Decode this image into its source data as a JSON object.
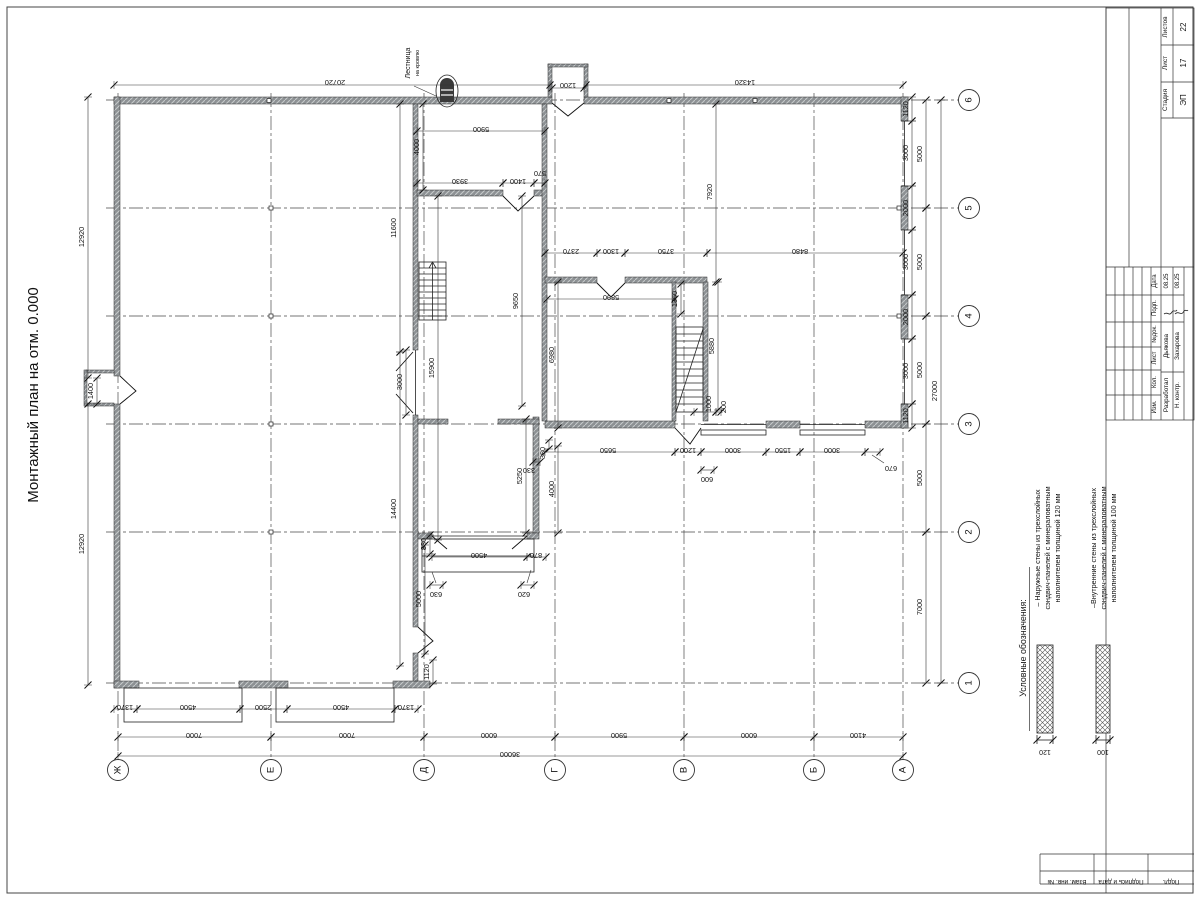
{
  "title": "Монтажный план на отм. 0.000",
  "roof_ladder_note": [
    "Лестница",
    "на кровлю"
  ],
  "legend": {
    "heading": "Условные обозначения:",
    "items": [
      {
        "lines": [
          "– Наружные стены из трехслойных",
          "сэндвич-панелей с минераловатным",
          "наполнителем толщиной 120 мм"
        ],
        "thickness": "120"
      },
      {
        "lines": [
          "–Внутренние стены из трехслойных",
          "сэндвич-панелей с минераловатным",
          "наполнителем толщиной 100 мм"
        ],
        "thickness": "100"
      }
    ]
  },
  "stamp": {
    "stadiya_label": "Стадия",
    "stadiya": "ЭП",
    "list_label": "Лист",
    "list": "17",
    "listov_label": "Листов",
    "listov": "22",
    "rev_headers": [
      "Дата",
      "Подп.",
      "№док.",
      "Лист",
      "Кол.",
      "Изм."
    ],
    "rows": [
      {
        "role": "Разработал",
        "name": "Дьякова",
        "date": "08.25"
      },
      {
        "role": "Н. контр.",
        "name": "Захарова",
        "date": "08.25"
      }
    ],
    "side_labels": [
      "Взам. инв. №",
      "Подпись и дата",
      "Подл."
    ]
  },
  "plan": {
    "axes": {
      "cols": [
        {
          "label": "Ж",
          "x": 118
        },
        {
          "label": "Е",
          "x": 271
        },
        {
          "label": "Д",
          "x": 424
        },
        {
          "label": "Г",
          "x": 555
        },
        {
          "label": "В",
          "x": 684
        },
        {
          "label": "Б",
          "x": 814
        },
        {
          "label": "А",
          "x": 903
        }
      ],
      "rows": [
        {
          "label": "6",
          "y": 100
        },
        {
          "label": "5",
          "y": 208
        },
        {
          "label": "4",
          "y": 316
        },
        {
          "label": "3",
          "y": 424
        },
        {
          "label": "2",
          "y": 532
        },
        {
          "label": "1",
          "y": 683
        }
      ],
      "col_line_y1": 93,
      "col_line_y2": 756,
      "col_bubble_y": 770,
      "row_line_x1": 106,
      "row_line_x2": 953,
      "row_bubble_x": 969,
      "bubble_r": 10.5
    },
    "dims": [
      [
        114,
        85,
        550,
        85,
        "20720",
        335,
        80,
        180
      ],
      [
        552,
        88,
        584,
        88,
        "1200",
        568,
        83,
        180
      ],
      [
        586,
        85,
        903,
        85,
        "14320",
        745,
        80,
        180
      ],
      [
        417,
        131,
        545,
        131,
        "5900",
        481,
        127,
        180
      ],
      [
        423,
        104,
        423,
        190,
        "4000",
        419,
        147,
        -90
      ],
      [
        417,
        183,
        503,
        183,
        "3930",
        460,
        179,
        180
      ],
      [
        503,
        183,
        534,
        183,
        "1400",
        518,
        179,
        180
      ],
      [
        534,
        183,
        545,
        183,
        "570",
        540,
        171,
        180
      ],
      [
        716,
        104,
        716,
        282,
        "7920",
        712,
        192,
        -90
      ],
      [
        545,
        253,
        597,
        253,
        "2370",
        571,
        249,
        180
      ],
      [
        597,
        253,
        625,
        253,
        "1300",
        611,
        249,
        180
      ],
      [
        625,
        253,
        707,
        253,
        "3750",
        666,
        249,
        180
      ],
      [
        707,
        253,
        903,
        253,
        "8480",
        800,
        249,
        180
      ],
      [
        547,
        299,
        675,
        299,
        "5890",
        611,
        295,
        180
      ],
      [
        681,
        284,
        681,
        314,
        "1360",
        677,
        299,
        -90
      ],
      [
        718,
        282,
        718,
        410,
        "5880",
        714,
        346,
        -90
      ],
      [
        522,
        196,
        522,
        406,
        "9650",
        518,
        301,
        -90
      ],
      [
        558,
        282,
        558,
        428,
        "6980",
        554,
        355,
        -90
      ],
      [
        400,
        104,
        400,
        352,
        "11600",
        396,
        228,
        -90
      ],
      [
        400,
        352,
        400,
        666,
        "14400",
        396,
        509,
        -90
      ],
      [
        438,
        196,
        438,
        540,
        "15900",
        434,
        368,
        -90
      ],
      [
        526,
        419,
        526,
        533,
        "5250",
        522,
        476,
        -90
      ],
      [
        558,
        446,
        558,
        533,
        "4000",
        554,
        489,
        -90
      ],
      [
        549,
        440,
        549,
        449,
        "380",
        545,
        453,
        -90
      ],
      [
        533,
        462,
        540,
        462,
        "330",
        529,
        468,
        180
      ],
      [
        545,
        452,
        675,
        452,
        "5650",
        608,
        448,
        180
      ],
      [
        675,
        452,
        701,
        452,
        "1200",
        688,
        448,
        180
      ],
      [
        701,
        452,
        766,
        452,
        "3000",
        733,
        448,
        180
      ],
      [
        766,
        452,
        800,
        452,
        "1550",
        783,
        448,
        180
      ],
      [
        800,
        452,
        865,
        452,
        "3000",
        832,
        448,
        180
      ],
      [
        865,
        452,
        880,
        452,
        "670",
        891,
        466,
        180
      ],
      [
        701,
        470,
        714,
        470,
        "600",
        707,
        477,
        180
      ],
      [
        912,
        97,
        912,
        121,
        "1120",
        908,
        109,
        -90
      ],
      [
        912,
        121,
        912,
        186,
        "3000",
        908,
        153,
        -90
      ],
      [
        912,
        186,
        912,
        230,
        "2000",
        908,
        208,
        -90
      ],
      [
        912,
        230,
        912,
        295,
        "3000",
        908,
        262,
        -90
      ],
      [
        912,
        295,
        912,
        339,
        "2000",
        908,
        317,
        -90
      ],
      [
        912,
        339,
        912,
        404,
        "3000",
        908,
        371,
        -90
      ],
      [
        912,
        404,
        912,
        428,
        "1120",
        908,
        416,
        -90
      ],
      [
        926,
        100,
        926,
        208,
        "5000",
        922,
        154,
        -90
      ],
      [
        926,
        208,
        926,
        316,
        "5000",
        922,
        262,
        -90
      ],
      [
        926,
        316,
        926,
        424,
        "5000",
        922,
        370,
        -90
      ],
      [
        926,
        424,
        926,
        532,
        "5000",
        922,
        478,
        -90
      ],
      [
        926,
        532,
        926,
        683,
        "7000",
        922,
        607,
        -90
      ],
      [
        941,
        100,
        941,
        683,
        "27000",
        937,
        391,
        -90
      ],
      [
        88,
        97,
        88,
        378,
        "12920",
        84,
        237,
        -90
      ],
      [
        88,
        404,
        88,
        685,
        "12920",
        84,
        544,
        -90
      ],
      [
        97,
        378,
        97,
        404,
        "1400",
        93,
        391,
        -90
      ],
      [
        114,
        709,
        137,
        709,
        "1370",
        125,
        705,
        180
      ],
      [
        137,
        709,
        240,
        709,
        "4500",
        188,
        705,
        180
      ],
      [
        240,
        709,
        287,
        709,
        "2500",
        263,
        705,
        180
      ],
      [
        287,
        709,
        395,
        709,
        "4500",
        341,
        705,
        180
      ],
      [
        395,
        709,
        418,
        709,
        "1370",
        406,
        705,
        180
      ],
      [
        118,
        737,
        271,
        737,
        "7000",
        194,
        733,
        180
      ],
      [
        271,
        737,
        424,
        737,
        "7000",
        347,
        733,
        180
      ],
      [
        424,
        737,
        555,
        737,
        "6000",
        489,
        733,
        180
      ],
      [
        555,
        737,
        684,
        737,
        "5900",
        619,
        733,
        180
      ],
      [
        684,
        737,
        814,
        737,
        "6000",
        749,
        733,
        180
      ],
      [
        814,
        737,
        903,
        737,
        "4100",
        858,
        733,
        180
      ],
      [
        118,
        756,
        903,
        756,
        "36000",
        510,
        752,
        180
      ],
      [
        433,
        660,
        433,
        684,
        "1120",
        429,
        672,
        -90
      ],
      [
        425,
        545,
        425,
        654,
        "5000",
        421,
        599,
        -90
      ],
      [
        430,
        535,
        430,
        554,
        "880",
        426,
        544,
        -90
      ],
      [
        432,
        557,
        527,
        557,
        "4500",
        479,
        553,
        180
      ],
      [
        527,
        557,
        546,
        557,
        "870",
        536,
        553,
        180
      ],
      [
        406,
        350,
        406,
        415,
        "3000",
        402,
        382,
        -90
      ],
      [
        521,
        585,
        534,
        585,
        "620",
        524,
        592,
        180
      ],
      [
        430,
        585,
        443,
        585,
        "630",
        436,
        592,
        180
      ],
      [
        694,
        412,
        716,
        412,
        "1000",
        711,
        404,
        -90
      ],
      [
        716,
        412,
        721,
        412,
        "200",
        726,
        407,
        -90
      ]
    ]
  }
}
